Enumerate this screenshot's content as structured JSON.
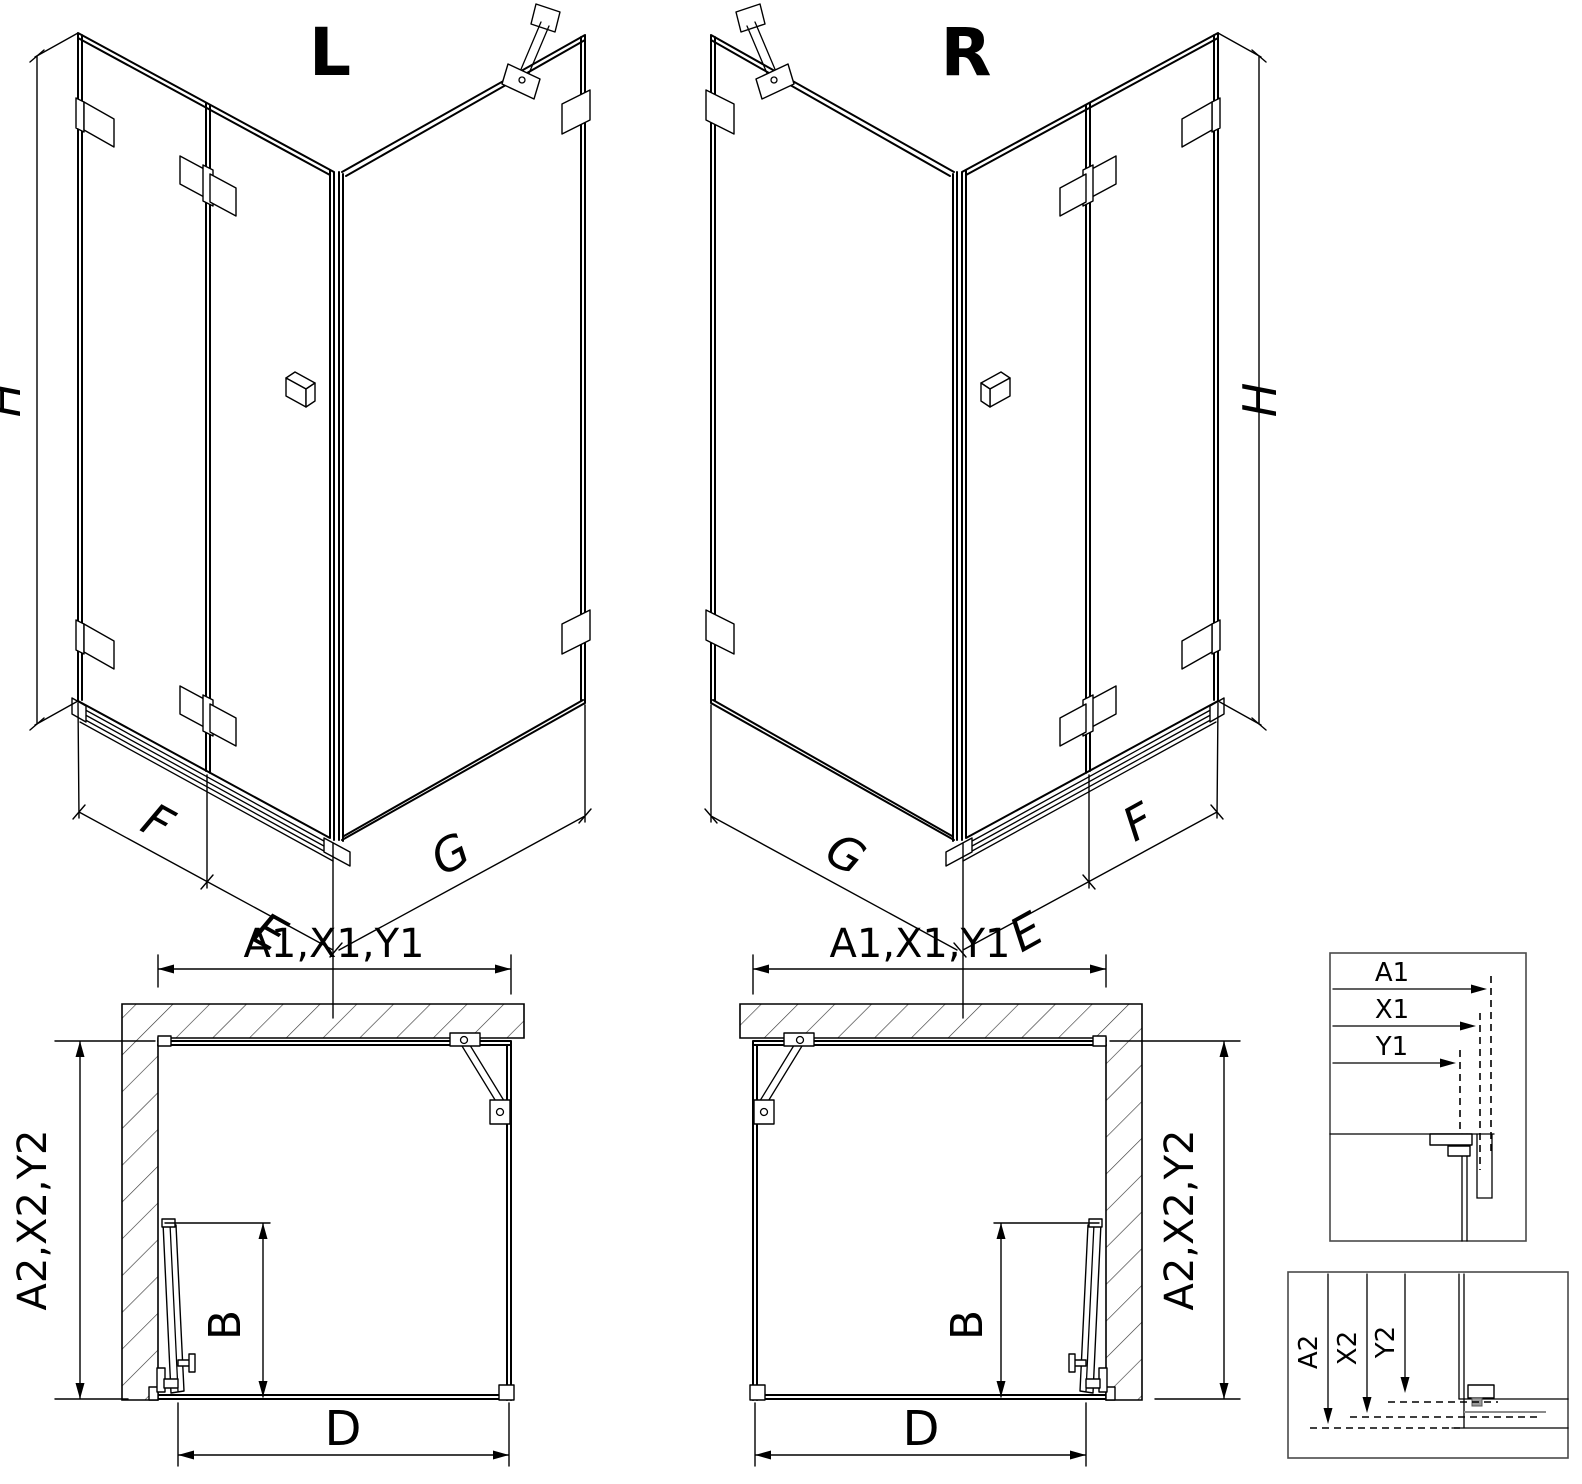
{
  "colors": {
    "line": "#000000",
    "background": "#ffffff",
    "detail_border": "#4a4a4a",
    "hatch": "#333333",
    "profile_gray": "#8a8a8a"
  },
  "iso_left": {
    "variant": "L",
    "height": "H",
    "panel_fixed": "F",
    "panel_door": "E",
    "panel_side": "G"
  },
  "iso_right": {
    "variant": "R",
    "height": "H",
    "panel_fixed": "F",
    "panel_door": "E",
    "panel_side": "G"
  },
  "plan_left": {
    "width_top": "A1,X1,Y1",
    "depth_side": "A2,X2,Y2",
    "door_swing": "B",
    "opening": "D"
  },
  "plan_right": {
    "width_top": "A1,X1,Y1",
    "depth_side": "A2,X2,Y2",
    "door_swing": "B",
    "opening": "D"
  },
  "detail_width": {
    "rows": [
      "A1",
      "X1",
      "Y1"
    ]
  },
  "detail_depth": {
    "rows": [
      "A2",
      "X2",
      "Y2"
    ]
  }
}
